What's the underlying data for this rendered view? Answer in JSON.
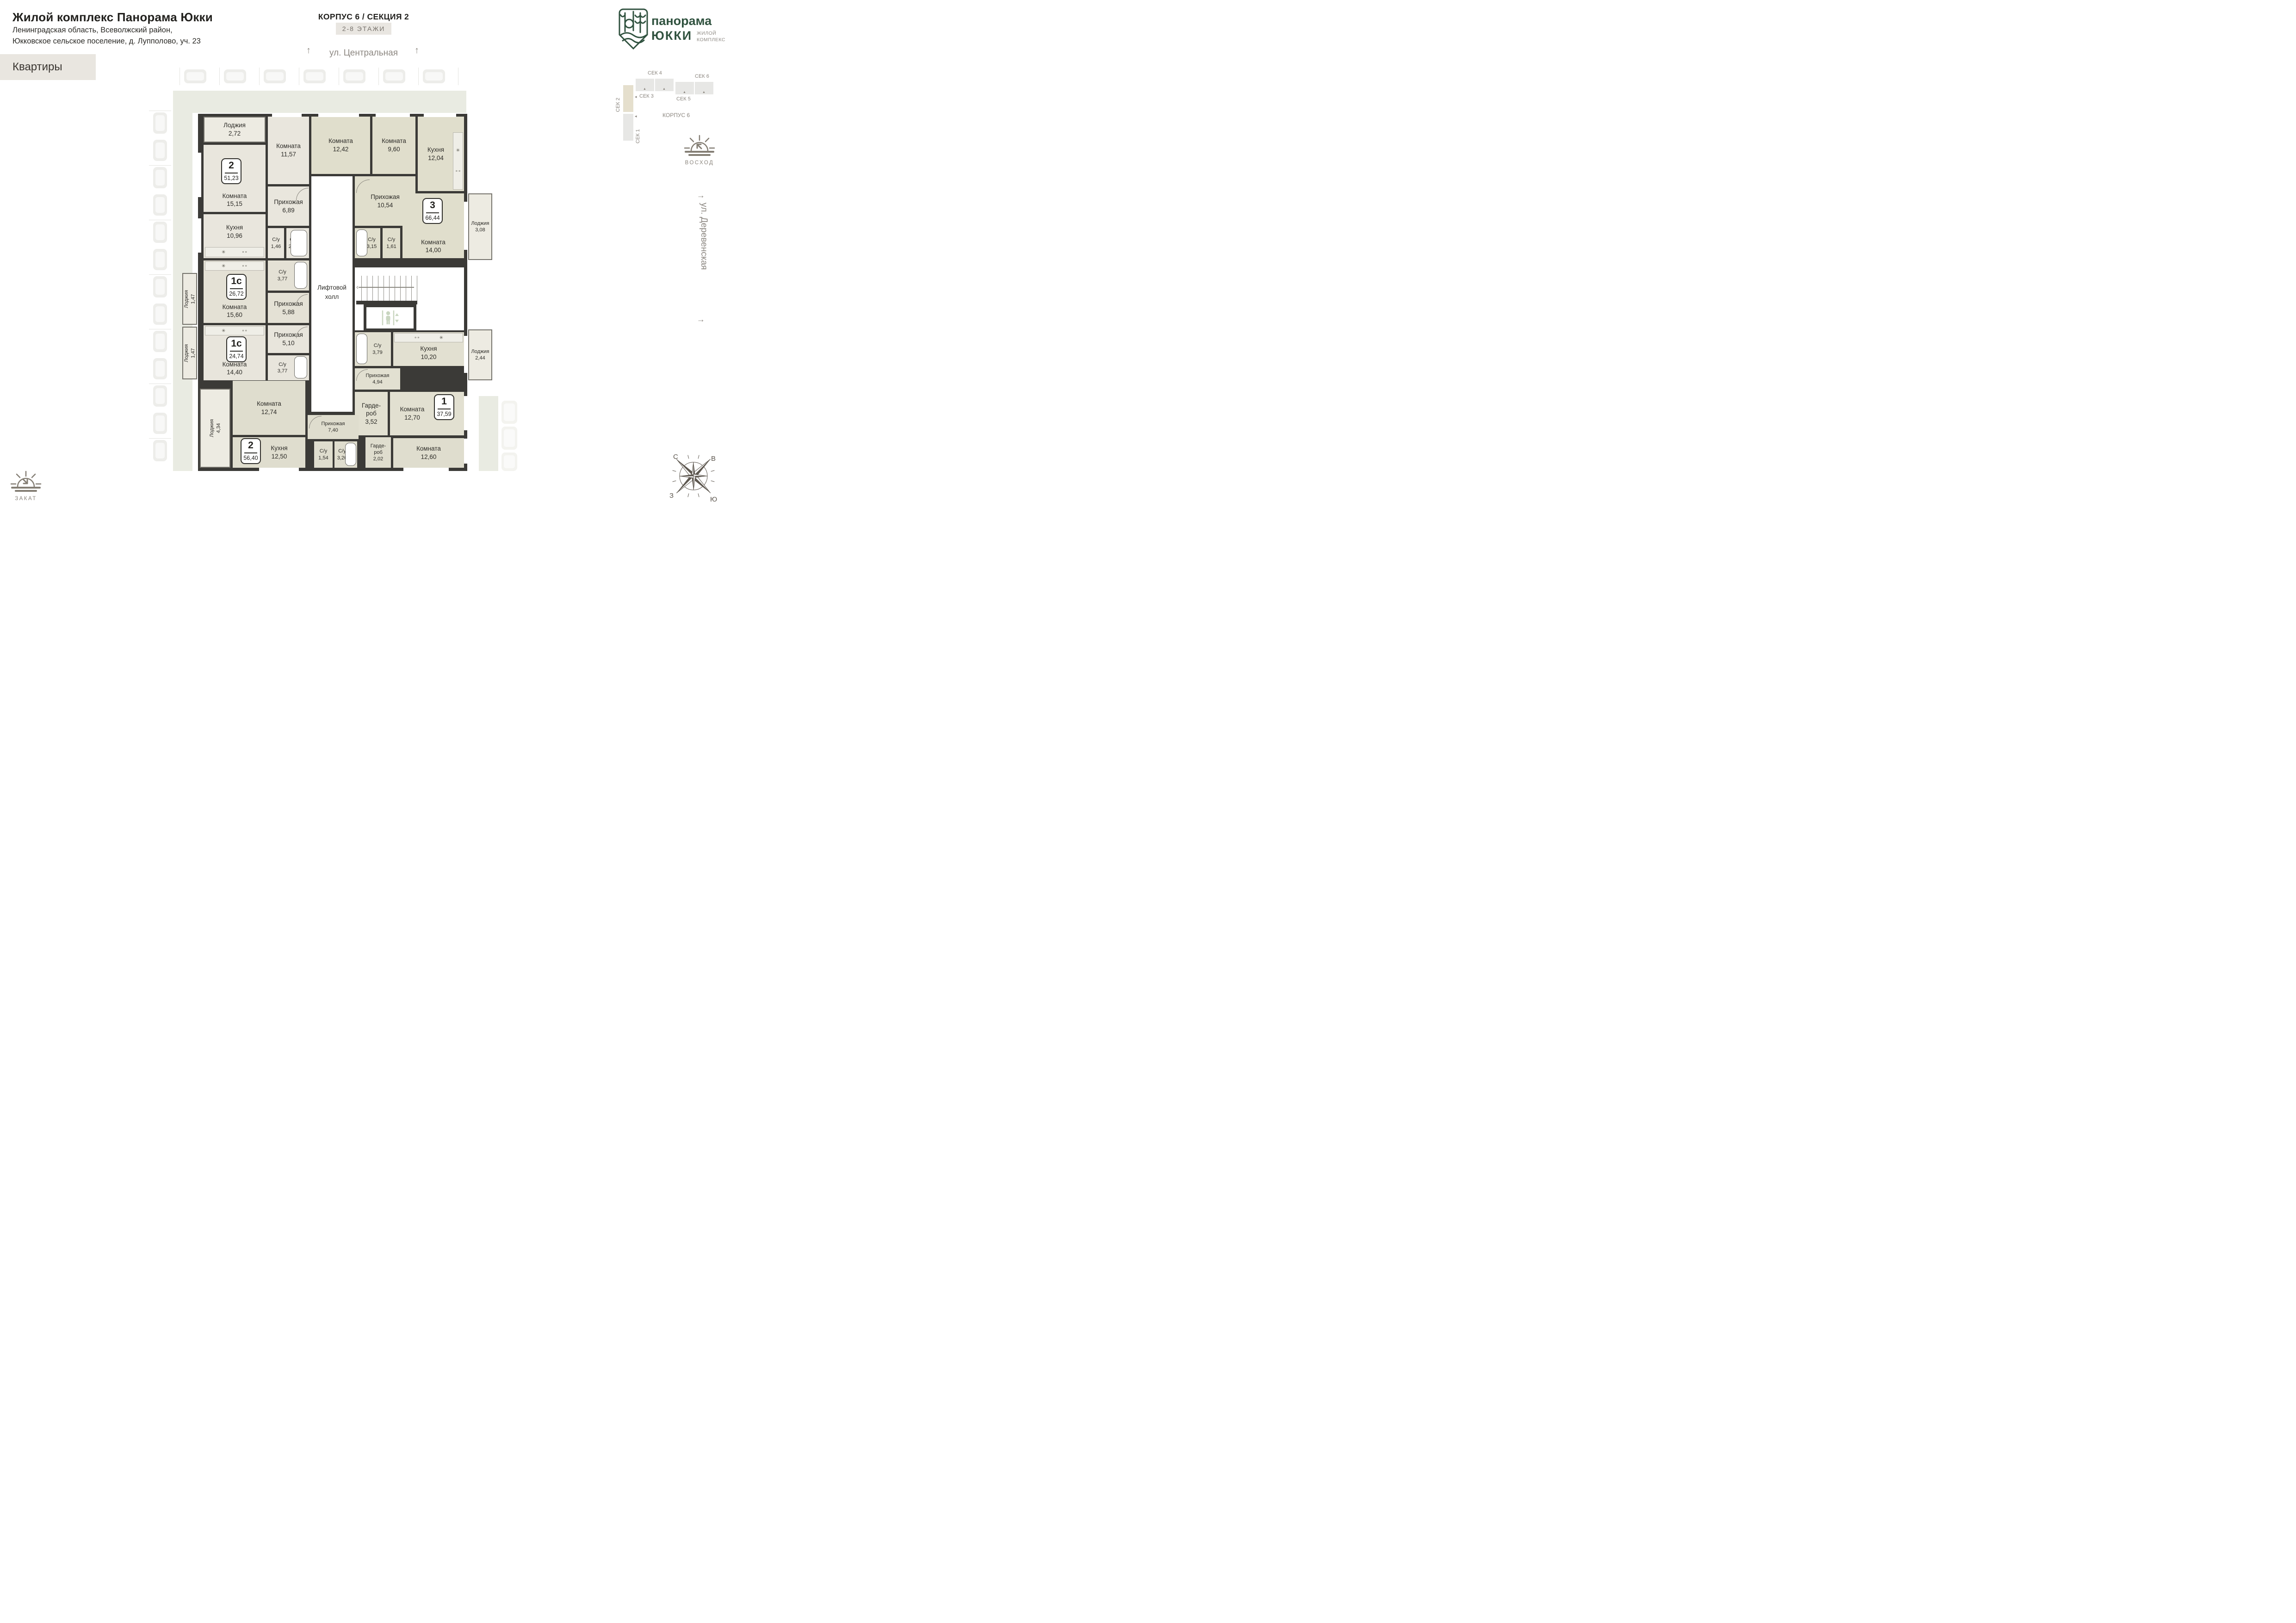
{
  "header": {
    "title": "Жилой комплекс Панорама Юкки",
    "address_line1": "Ленинградская область, Всеволжский район,",
    "address_line2": "Юкковское сельское поселение, д. Лупполово, уч. 23",
    "section_tab": "Квартиры"
  },
  "plan_header": {
    "corpus": "КОРПУС 6 / СЕКЦИЯ 2",
    "floors": "2-8 ЭТАЖИ"
  },
  "streets": {
    "top": "ул. Центральная",
    "right": "ул. Деревенская"
  },
  "logo": {
    "brand_top": "панорама",
    "brand_bottom": "ЮККИ",
    "tagline_line1": "ЖИЛОЙ",
    "tagline_line2": "КОМПЛЕКС"
  },
  "minimap": {
    "sec1": "СЕК 1",
    "sec2": "СЕК 2",
    "sec3": "СЕК 3",
    "sec4": "СЕК 4",
    "sec5": "СЕК 5",
    "sec6": "СЕК 6",
    "corpus": "КОРПУС 6"
  },
  "sun": {
    "sunrise": "ВОСХОД",
    "sunset": "ЗАКАТ"
  },
  "compass": {
    "n": "С",
    "e": "В",
    "s": "Ю",
    "w": "З"
  },
  "common": {
    "lift_hall_line1": "Лифтовой",
    "lift_hall_line2": "холл"
  },
  "icons": {
    "sink": "✳",
    "stove": "∘∘",
    "triangle_up": "▲",
    "arrow_left_small": "◂",
    "arrow_up": "↑",
    "arrow_right": "→",
    "chevron_left": "‹"
  },
  "apartments": [
    {
      "type": "2",
      "area": "51,23",
      "rooms": [
        {
          "name": "Лоджия",
          "area": "2,72"
        },
        {
          "name": "Комната",
          "area": "11,57"
        },
        {
          "name": "Комната",
          "area": "15,15"
        },
        {
          "name": "Прихожая",
          "area": "6,89"
        },
        {
          "name": "Кухня",
          "area": "10,96"
        },
        {
          "name": "С/у",
          "area": "1,46"
        },
        {
          "name": "С/у",
          "area": "2,48"
        }
      ]
    },
    {
      "type": "3",
      "area": "66,44",
      "rooms": [
        {
          "name": "Комната",
          "area": "12,42"
        },
        {
          "name": "Комната",
          "area": "9,60"
        },
        {
          "name": "Кухня",
          "area": "12,04"
        },
        {
          "name": "Прихожая",
          "area": "10,54"
        },
        {
          "name": "С/у",
          "area": "3,15"
        },
        {
          "name": "С/у",
          "area": "1,61"
        },
        {
          "name": "Комната",
          "area": "14,00"
        },
        {
          "name": "Лоджия",
          "area": "3,08"
        }
      ]
    },
    {
      "type": "1с",
      "area": "26,72",
      "rooms": [
        {
          "name": "Лоджия",
          "area": "1,47"
        },
        {
          "name": "Комната",
          "area": "15,60"
        },
        {
          "name": "С/у",
          "area": "3,77"
        },
        {
          "name": "Прихожая",
          "area": "5,88"
        }
      ]
    },
    {
      "type": "1с",
      "area": "24,74",
      "rooms": [
        {
          "name": "Лоджия",
          "area": "1,47"
        },
        {
          "name": "Комната",
          "area": "14,40"
        },
        {
          "name": "Прихожая",
          "area": "5,10"
        },
        {
          "name": "С/у",
          "area": "3,77"
        }
      ]
    },
    {
      "type": "1",
      "area": "37,59",
      "rooms": [
        {
          "name": "С/у",
          "area": "3,79"
        },
        {
          "name": "Кухня",
          "area": "10,20"
        },
        {
          "name": "Лоджия",
          "area": "2,44"
        },
        {
          "name": "Прихожая",
          "area": "4,94"
        },
        {
          "name": "Гарде-\nроб",
          "area": "3,52"
        },
        {
          "name": "Комната",
          "area": "12,70"
        }
      ]
    },
    {
      "type": "2",
      "area": "56,40",
      "rooms": [
        {
          "name": "Лоджия",
          "area": "4,34"
        },
        {
          "name": "Комната",
          "area": "12,74"
        },
        {
          "name": "Прихожая",
          "area": "7,40"
        },
        {
          "name": "Кухня",
          "area": "12,50"
        },
        {
          "name": "С/у",
          "area": "1,54"
        },
        {
          "name": "С/у",
          "area": "3,26"
        },
        {
          "name": "Гарде-\nроб",
          "area": "2,02"
        },
        {
          "name": "Комната",
          "area": "12,60"
        }
      ]
    }
  ],
  "colors": {
    "wall": "#3b3a37",
    "street_band": "#e9ebe2",
    "highlight_beige": "#e5dfcd",
    "brand_green": "#30523f"
  }
}
